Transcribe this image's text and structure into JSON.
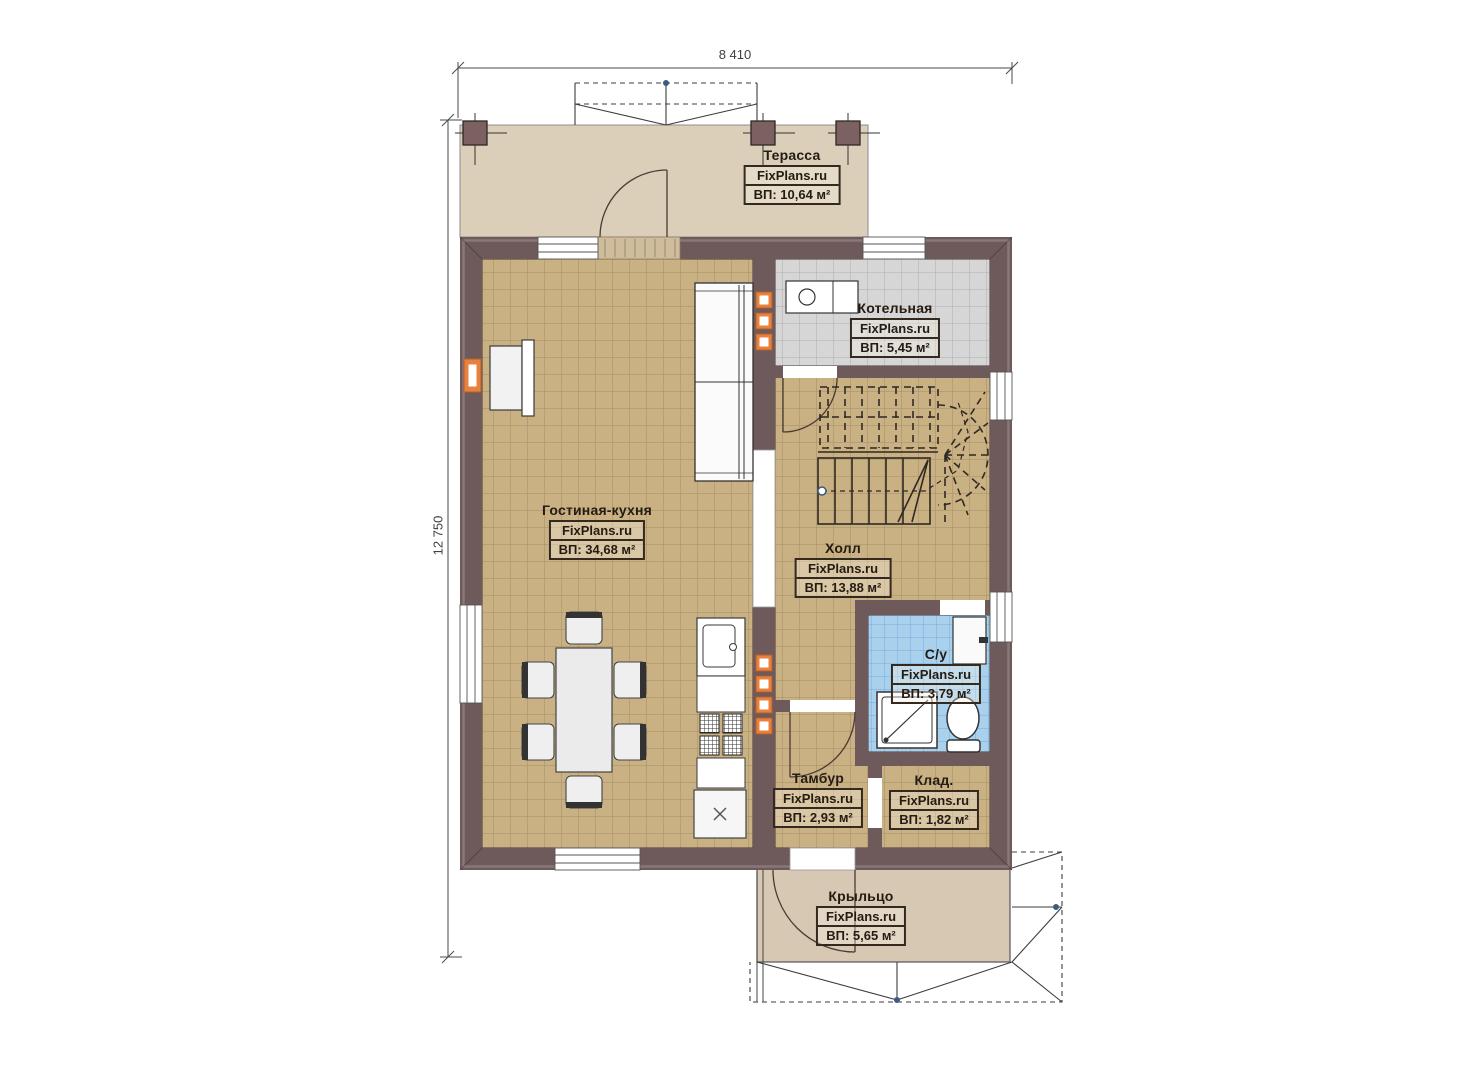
{
  "plan": {
    "brand": "FixPlans.ru",
    "dimensions": {
      "width": "8 410",
      "height": "12 750"
    },
    "colors": {
      "wall": "#6e5a5a",
      "floor_living": "#c9b183",
      "floor_boiler": "#d6d6d6",
      "floor_bathroom": "#a9d1ee",
      "floor_terrace": "#dbcfba",
      "floor_porch": "#d6c8b2",
      "vent_accent": "#e8803f",
      "label_border": "#33291f"
    },
    "rooms": {
      "terrace": {
        "name": "Терасса",
        "brand": "FixPlans.ru",
        "area": "ВП: 10,64 м²"
      },
      "boiler": {
        "name": "Котельная",
        "brand": "FixPlans.ru",
        "area": "ВП: 5,45 м²"
      },
      "living": {
        "name": "Гостиная-кухня",
        "brand": "FixPlans.ru",
        "area": "ВП: 34,68 м²"
      },
      "hall": {
        "name": "Холл",
        "brand": "FixPlans.ru",
        "area": "ВП: 13,88 м²"
      },
      "bathroom": {
        "name": "С/у",
        "brand": "FixPlans.ru",
        "area": "ВП: 3,79 м²"
      },
      "vestibule": {
        "name": "Тамбур",
        "brand": "FixPlans.ru",
        "area": "ВП: 2,93 м²"
      },
      "storage": {
        "name": "Клад.",
        "brand": "FixPlans.ru",
        "area": "ВП: 1,82 м²"
      },
      "porch": {
        "name": "Крыльцо",
        "brand": "FixPlans.ru",
        "area": "ВП: 5,65 м²"
      }
    }
  }
}
